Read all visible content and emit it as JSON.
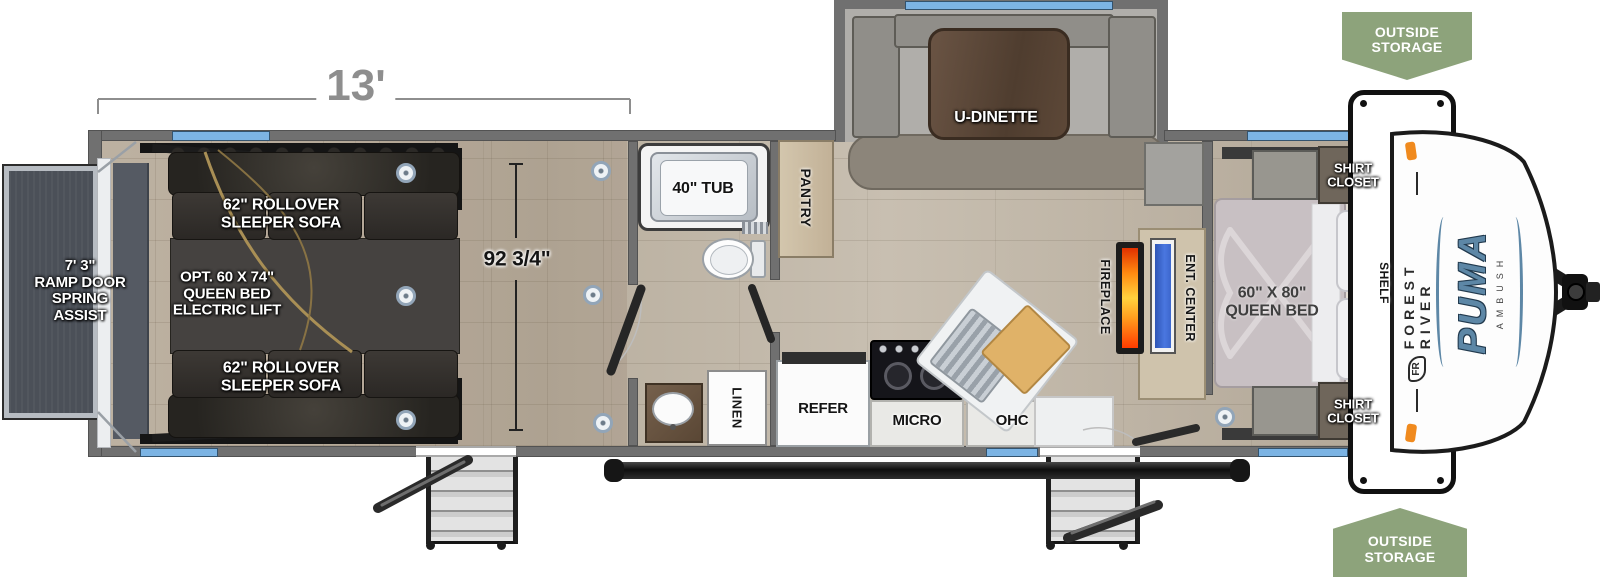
{
  "diagram": {
    "dimensions": {
      "slide_length": "13'",
      "interior_width": "92 3/4\""
    },
    "garage": {
      "ramp_door": "7' 3\"\nRAMP DOOR\nSPRING\nASSIST",
      "sleeper_sofa": "62\" ROLLOVER\nSLEEPER SOFA",
      "bed_lift_option": "OPT. 60 X 74\"\nQUEEN BED\nELECTRIC LIFT"
    },
    "bathroom": {
      "tub": "40\" TUB",
      "linen": "LINEN"
    },
    "kitchen": {
      "pantry": "PANTRY",
      "dinette": "U-DINETTE",
      "refer": "REFER",
      "micro": "MICRO",
      "ohc": "OHC"
    },
    "living": {
      "fireplace": "FIREPLACE",
      "ent_center": "ENT. CENTER"
    },
    "bedroom": {
      "bed": "60\" X 80\"\nQUEEN BED",
      "shelf": "SHELF",
      "shirt_closet": "SHIRT\nCLOSET"
    },
    "exterior": {
      "outside_storage": "OUTSIDE\nSTORAGE"
    },
    "branding": {
      "make": "FOREST RIVER",
      "logo": "FR",
      "model": "PUMA",
      "trim": "AMBUSH"
    },
    "colors": {
      "window_blue": "#7cb4e4",
      "badge_green": "#8da37b",
      "fireplace_orange": "#ff8a1e",
      "tv_blue": "#3c66cc",
      "brand_blue": "#5d87a6",
      "wall_gray": "#707070"
    }
  }
}
